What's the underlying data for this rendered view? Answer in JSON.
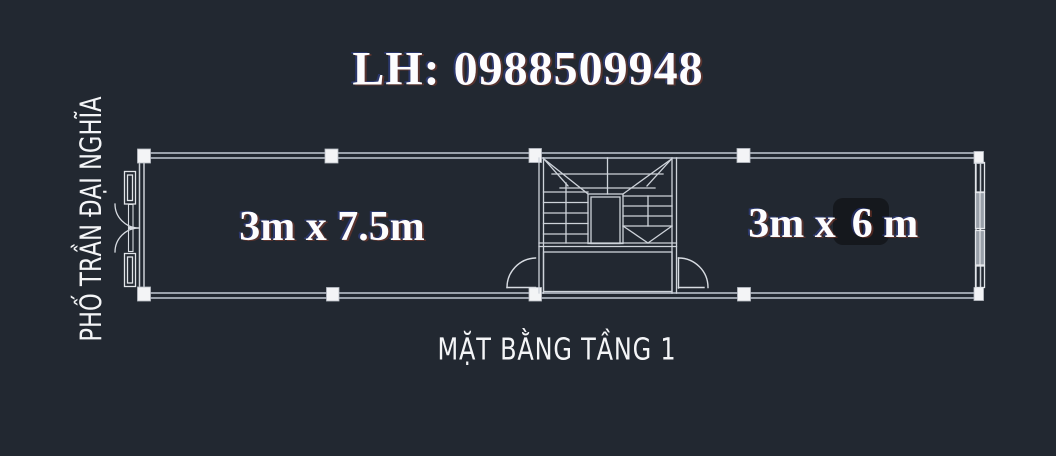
{
  "title": "LH: 0988509948",
  "street": {
    "name": "PHỐ TRẦN ĐẠI NGHĨA"
  },
  "rooms": {
    "left": {
      "dimensions": "3m x 7.5m"
    },
    "right": {
      "dimensions_prefix": "3m x",
      "dimensions_suffix": "6 m"
    }
  },
  "caption": "MẶT BẰNG TẦNG 1",
  "colors": {
    "background": "#222831",
    "wall_line": "#9aa1ab",
    "symbol_line": "#ced3da",
    "column_fill": "#f3f4f6",
    "window_fill": "#989fa8",
    "text": "#fdfdfe",
    "redaction_patch": "#15181d"
  }
}
